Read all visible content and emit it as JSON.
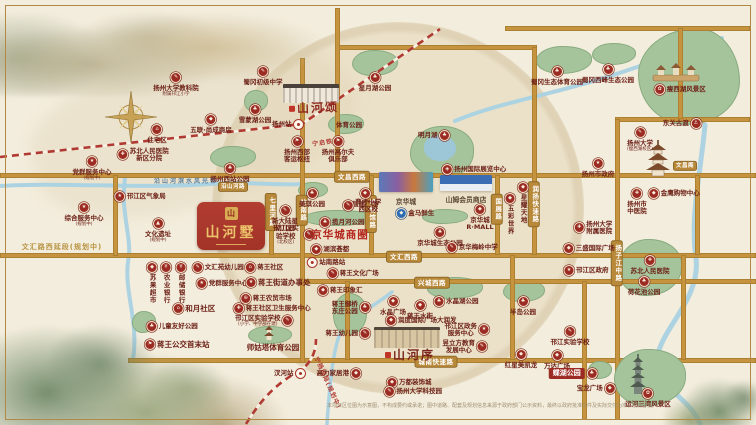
{
  "colors": {
    "paper": "#f3eddd",
    "road_gold": "#c6933e",
    "pill_gold": "#b9893a",
    "badge_red": "#9c2b24",
    "badge_blue": "#2a6bb5",
    "park_green": "#a6c49c",
    "river_blue": "#a9d2e3",
    "rail_red": "#b03a32",
    "project_red": "#b23d31",
    "seal_gold": "#d9ad55",
    "biz_red": "#b5241c",
    "text_dark": "#6e2218"
  },
  "projects": {
    "main": {
      "name": "山河墅",
      "x": 197,
      "y": 202,
      "w": 68,
      "h": 48
    },
    "song": {
      "name": "山河颂",
      "bx": 283,
      "by": 84,
      "bw": 56,
      "bh": 15,
      "tx": 314,
      "ty": 99
    },
    "xu": {
      "name": "山河序",
      "bx": 374,
      "by": 327,
      "bw": 66,
      "bh": 18,
      "tx": 410,
      "ty": 346
    }
  },
  "malls": [
    {
      "name": "京华城",
      "x": 379,
      "y": 172,
      "w": 54,
      "h": 20,
      "ly": 196,
      "style": "jhc"
    },
    {
      "name": "山姆会员商店",
      "x": 440,
      "y": 175,
      "w": 52,
      "h": 16,
      "ly": 194,
      "style": "sam"
    }
  ],
  "roads": {
    "h": [
      {
        "y": 175,
        "x1": 0,
        "x2": 756
      },
      {
        "y": 255,
        "x1": 0,
        "x2": 756
      },
      {
        "y": 281,
        "x1": 302,
        "x2": 756
      },
      {
        "y": 360,
        "x1": 128,
        "x2": 756
      },
      {
        "y": 47,
        "x1": 337,
        "x2": 537
      },
      {
        "y": 28,
        "x1": 505,
        "x2": 750
      },
      {
        "y": 119,
        "x1": 615,
        "x2": 750
      }
    ],
    "v": [
      {
        "x": 302,
        "y1": 58,
        "y2": 363
      },
      {
        "x": 337,
        "y1": 8,
        "y2": 175
      },
      {
        "x": 271,
        "y1": 196,
        "y2": 255
      },
      {
        "x": 371,
        "y1": 175,
        "y2": 255
      },
      {
        "x": 497,
        "y1": 175,
        "y2": 255
      },
      {
        "x": 534,
        "y1": 47,
        "y2": 255
      },
      {
        "x": 617,
        "y1": 119,
        "y2": 420
      },
      {
        "x": 584,
        "y1": 281,
        "y2": 420
      },
      {
        "x": 683,
        "y1": 255,
        "y2": 360
      },
      {
        "x": 697,
        "y1": 175,
        "y2": 255
      },
      {
        "x": 512,
        "y1": 255,
        "y2": 360
      },
      {
        "x": 347,
        "y1": 281,
        "y2": 360
      },
      {
        "x": 115,
        "y1": 175,
        "y2": 256
      },
      {
        "x": 680,
        "y1": 28,
        "y2": 119
      }
    ],
    "pills": [
      {
        "label": "文昌西路",
        "x": 352,
        "y": 177
      },
      {
        "label": "文汇西路",
        "x": 404,
        "y": 257
      },
      {
        "label": "兴城西路",
        "x": 432,
        "y": 283
      },
      {
        "label": "城南快速路",
        "x": 436,
        "y": 362
      },
      {
        "label": "站南路",
        "x": 302,
        "y": 210,
        "vert": true
      },
      {
        "label": "七里河路",
        "x": 271,
        "y": 212,
        "vert": true
      },
      {
        "label": "博物馆路",
        "x": 371,
        "y": 214,
        "vert": true
      },
      {
        "label": "国展路",
        "x": 497,
        "y": 209,
        "vert": true
      },
      {
        "label": "润扬快速路",
        "x": 534,
        "y": 204,
        "vert": true
      },
      {
        "label": "扬子江中路",
        "x": 617,
        "y": 263,
        "vert": true
      },
      {
        "label": "沿山河路",
        "x": 233,
        "y": 187,
        "small": true
      },
      {
        "label": "文昌阁",
        "x": 685,
        "y": 166,
        "small": true
      }
    ],
    "extra": [
      {
        "label": "文汇路西延段(规划中)",
        "x": 62,
        "y": 242
      }
    ]
  },
  "railways": {
    "lines": [
      {
        "d": "M0,157 L302,124 L440,29"
      },
      {
        "d": "M246,424 C262,398 276,384 299,371 C311,364 316,352 316,339"
      }
    ],
    "labels": [
      {
        "label": "宁启铁路",
        "x": 312,
        "y": 137,
        "rot": -8
      },
      {
        "label": "宁扬城际(规划中)",
        "x": 300,
        "y": 378,
        "rot": 66
      }
    ]
  },
  "rivers": [
    {
      "d": "M0,186 C60,182 140,189 210,184 C250,181 280,186 303,184",
      "w": 4
    },
    {
      "d": "M125,178 C120,215 133,238 128,262 C124,292 139,322 133,360",
      "w": 4
    },
    {
      "d": "M455,121 C505,100 565,93 640,66 C678,53 700,48 722,38",
      "w": 4
    },
    {
      "d": "M705,125 C700,178 690,218 696,258 C701,300 659,330 657,360 C655,386 692,400 700,424",
      "w": 5
    },
    {
      "d": "M392,292 C372,308 352,316 342,330 C334,343 330,378 327,424",
      "w": 3.5
    }
  ],
  "parks": [
    {
      "x": 352,
      "y": 50,
      "w": 44,
      "h": 24
    },
    {
      "x": 244,
      "y": 90,
      "w": 22,
      "h": 20
    },
    {
      "x": 210,
      "y": 146,
      "w": 44,
      "h": 20
    },
    {
      "x": 328,
      "y": 114,
      "w": 34,
      "h": 18
    },
    {
      "x": 536,
      "y": 46,
      "w": 54,
      "h": 26
    },
    {
      "x": 592,
      "y": 43,
      "w": 42,
      "h": 20
    },
    {
      "x": 638,
      "y": 28,
      "w": 100,
      "h": 95,
      "r": "58% 42% 52% 48% / 48% 55% 45% 52%"
    },
    {
      "x": 410,
      "y": 126,
      "w": 62,
      "h": 50,
      "r": "50% 50% 46% 54% / 55% 45% 52% 48%"
    },
    {
      "x": 303,
      "y": 210,
      "w": 70,
      "h": 14
    },
    {
      "x": 422,
      "y": 209,
      "w": 44,
      "h": 13
    },
    {
      "x": 503,
      "y": 280,
      "w": 40,
      "h": 20
    },
    {
      "x": 427,
      "y": 277,
      "w": 54,
      "h": 20
    },
    {
      "x": 333,
      "y": 293,
      "w": 32,
      "h": 40
    },
    {
      "x": 132,
      "y": 311,
      "w": 22,
      "h": 20,
      "front": true
    },
    {
      "x": 248,
      "y": 326,
      "w": 42,
      "h": 16,
      "front": true
    },
    {
      "x": 618,
      "y": 239,
      "w": 62,
      "h": 55
    },
    {
      "x": 614,
      "y": 349,
      "w": 70,
      "h": 55,
      "front": true
    },
    {
      "x": 298,
      "y": 182,
      "w": 28,
      "h": 14
    },
    {
      "x": 588,
      "y": 361,
      "w": 22,
      "h": 16,
      "front": true
    }
  ],
  "lakes": [
    {
      "x": 424,
      "y": 135,
      "w": 32,
      "h": 26
    }
  ],
  "water_text": {
    "label": "沿山河滨水风光带",
    "x": 186,
    "y": 176
  },
  "pois": [
    {
      "l": "扬州大学教科院",
      "s": "附属邗江小学",
      "x": 176,
      "y": 72,
      "b": "top",
      "i": "school"
    },
    {
      "l": "蜀冈初级中学",
      "x": 263,
      "y": 66,
      "b": "top",
      "i": "school"
    },
    {
      "l": "星月湖公园",
      "x": 375,
      "y": 72,
      "b": "top",
      "i": "park"
    },
    {
      "l": "雪蒙湖公园",
      "x": 255,
      "y": 104,
      "b": "top",
      "i": "park"
    },
    {
      "l": "五联·尚成商房",
      "x": 211,
      "y": 114,
      "b": "top",
      "i": "shop"
    },
    {
      "l": "住宅区",
      "x": 157,
      "y": 124,
      "b": "top",
      "i": "home"
    },
    {
      "l": "苏北人民医院",
      "s": "新区分院",
      "eq": true,
      "x": 143,
      "y": 147,
      "b": "left",
      "i": "hospital"
    },
    {
      "l": "党群服务中心",
      "s": "(规划中)",
      "x": 92,
      "y": 156,
      "b": "top",
      "i": "star"
    },
    {
      "l": "综合服务中心",
      "s": "(规划中)",
      "x": 84,
      "y": 202,
      "b": "top",
      "i": "gov"
    },
    {
      "l": "邗江区气象局",
      "x": 140,
      "y": 191,
      "b": "left",
      "i": "gov"
    },
    {
      "l": "文化遗址",
      "s": "(规划中)",
      "x": 158,
      "y": 218,
      "b": "top",
      "i": "heritage"
    },
    {
      "l": "扬州西站公园",
      "x": 230,
      "y": 163,
      "b": "top",
      "i": "park"
    },
    {
      "l": "扬州站",
      "x": 288,
      "y": 119,
      "b": "right",
      "i": "rail"
    },
    {
      "l": "体育公园",
      "x": 349,
      "y": 121,
      "b": "none"
    },
    {
      "l": "扬州西部",
      "s": "客运枢纽",
      "eq": true,
      "x": 297,
      "y": 136,
      "b": "top",
      "i": "bus"
    },
    {
      "l": "扬州高尔夫",
      "s": "俱乐部",
      "eq": true,
      "x": 338,
      "y": 136,
      "b": "top",
      "i": "golf"
    },
    {
      "l": "明月湖",
      "x": 434,
      "y": 130,
      "b": "right",
      "i": "park"
    },
    {
      "l": "扬州国际展览中心",
      "x": 474,
      "y": 164,
      "b": "left",
      "i": "expo"
    },
    {
      "l": "蜀冈生态体育公园",
      "x": 557,
      "y": 66,
      "b": "top",
      "i": "park"
    },
    {
      "l": "蜀冈西峰生态公园",
      "x": 608,
      "y": 64,
      "b": "top",
      "i": "park"
    },
    {
      "l": "瘦西湖风景区",
      "x": 680,
      "y": 84,
      "b": "left",
      "i": "scenic"
    },
    {
      "l": "东关古渡",
      "x": 682,
      "y": 118,
      "b": "right",
      "i": "ferry"
    },
    {
      "l": "扬州大学",
      "s": "(瘦西湖校区)",
      "x": 640,
      "y": 127,
      "b": "top",
      "i": "school"
    },
    {
      "l": "扬州市政府",
      "x": 598,
      "y": 158,
      "b": "top",
      "i": "star"
    },
    {
      "l": "美琪公园",
      "x": 312,
      "y": 188,
      "b": "top",
      "i": "park"
    },
    {
      "l": "昌建广场",
      "x": 365,
      "y": 188,
      "b": "top",
      "i": "shop"
    },
    {
      "l": "育才小学",
      "s": "西区校",
      "eq": true,
      "x": 362,
      "y": 198,
      "b": "left",
      "i": "school"
    },
    {
      "l": "新大陆星",
      "s": "幼儿园",
      "eq": true,
      "x": 285,
      "y": 205,
      "b": "top",
      "i": "school"
    },
    {
      "l": "邗江区实验学校",
      "s": "(北校区)",
      "x": 292,
      "y": 224,
      "b": "right",
      "i": "school",
      "w": 32
    },
    {
      "l": "揽月河公园",
      "x": 342,
      "y": 217,
      "b": "left",
      "i": "park"
    },
    {
      "l": "京华城商圈",
      "x": 340,
      "y": 229,
      "c": "biz",
      "b": "none"
    },
    {
      "l": "湖滨荟都",
      "x": 330,
      "y": 244,
      "b": "left",
      "i": "shop"
    },
    {
      "l": "站南路站",
      "x": 326,
      "y": 257,
      "b": "left",
      "i": "metro"
    },
    {
      "l": "蒋王文化广场",
      "x": 353,
      "y": 268,
      "b": "left",
      "i": "culture"
    },
    {
      "l": "蒋王印象汇",
      "x": 340,
      "y": 285,
      "b": "left",
      "i": "shop"
    },
    {
      "l": "盒马鲜生",
      "x": 415,
      "y": 208,
      "b": "left",
      "i": "hema"
    },
    {
      "l": "京华城生态公园",
      "x": 440,
      "y": 227,
      "b": "top",
      "i": "park"
    },
    {
      "l": "京华城",
      "s": "R·MALL",
      "eq": true,
      "x": 480,
      "y": 204,
      "b": "top",
      "i": "shop"
    },
    {
      "l": "京华梅岭中学",
      "x": 472,
      "y": 242,
      "b": "left",
      "i": "school"
    },
    {
      "l": "星耀天地",
      "x": 523,
      "y": 182,
      "b": "top",
      "i": "shop",
      "v": true
    },
    {
      "l": "五彩世界",
      "x": 510,
      "y": 193,
      "b": "top",
      "i": "shop",
      "v": true
    },
    {
      "l": "扬州市",
      "s": "中医院",
      "eq": true,
      "x": 637,
      "y": 188,
      "b": "top",
      "i": "hospital"
    },
    {
      "l": "金鹰购物中心",
      "x": 674,
      "y": 188,
      "b": "left",
      "i": "shop"
    },
    {
      "l": "扬州大学",
      "s": "附属医院",
      "eq": true,
      "x": 593,
      "y": 220,
      "b": "left",
      "i": "hospital"
    },
    {
      "l": "三盛国际广场",
      "x": 589,
      "y": 243,
      "b": "left",
      "i": "shop"
    },
    {
      "l": "邗江区政府",
      "x": 586,
      "y": 265,
      "b": "left",
      "i": "star"
    },
    {
      "l": "苏北人民医院",
      "x": 650,
      "y": 255,
      "b": "top",
      "i": "hospital"
    },
    {
      "l": "荷花池公园",
      "x": 644,
      "y": 276,
      "b": "top",
      "i": "park"
    },
    {
      "l": "苏果超市",
      "x": 152,
      "y": 262,
      "b": "top",
      "i": "shop",
      "v": true
    },
    {
      "l": "农业银行",
      "x": 166,
      "y": 262,
      "b": "top",
      "i": "bank",
      "v": true
    },
    {
      "l": "邮储银行",
      "x": 181,
      "y": 262,
      "b": "top",
      "i": "bank",
      "v": true
    },
    {
      "l": "文汇苑幼儿园",
      "x": 218,
      "y": 262,
      "b": "left",
      "i": "school"
    },
    {
      "l": "蒋王社区",
      "x": 264,
      "y": 262,
      "b": "left",
      "i": "community"
    },
    {
      "l": "党群服务中心",
      "x": 222,
      "y": 278,
      "b": "left",
      "i": "star"
    },
    {
      "l": "蒋王街道办事处",
      "x": 278,
      "y": 277,
      "b": "left",
      "i": "gov",
      "c": "lg"
    },
    {
      "l": "蒋王农贸市场",
      "x": 266,
      "y": 293,
      "b": "left",
      "i": "market"
    },
    {
      "l": "蒋王社区卫生服务中心",
      "x": 272,
      "y": 303,
      "b": "left",
      "i": "hospital"
    },
    {
      "l": "和月社区",
      "x": 194,
      "y": 303,
      "b": "left",
      "i": "community",
      "c": "lg"
    },
    {
      "l": "邗江区实验学校",
      "s": "(小学、中学部在建)",
      "x": 264,
      "y": 314,
      "b": "right",
      "i": "school"
    },
    {
      "l": "儿童友好公园",
      "x": 172,
      "y": 321,
      "b": "left",
      "i": "park"
    },
    {
      "l": "蒋王公交首末站",
      "x": 177,
      "y": 339,
      "b": "left",
      "i": "bus",
      "c": "lg"
    },
    {
      "l": "师姑塔体育公园",
      "x": 273,
      "y": 343,
      "b": "none",
      "c": "lg"
    },
    {
      "l": "蒋王御桥",
      "s": "东庄公园",
      "eq": true,
      "x": 351,
      "y": 300,
      "b": "right",
      "i": "park"
    },
    {
      "l": "蒋王幼儿园",
      "x": 348,
      "y": 328,
      "b": "right",
      "i": "school"
    },
    {
      "l": "水晶广场",
      "x": 393,
      "y": 296,
      "b": "top",
      "i": "shop"
    },
    {
      "l": "蒋王水街",
      "x": 420,
      "y": 300,
      "b": "top",
      "i": "shop"
    },
    {
      "l": "水晶湖公园",
      "x": 456,
      "y": 296,
      "b": "left",
      "i": "park"
    },
    {
      "l": "润度国际广场大润发",
      "x": 421,
      "y": 315,
      "b": "left",
      "i": "shop"
    },
    {
      "l": "邗江区政务",
      "s": "服务中心",
      "eq": true,
      "x": 467,
      "y": 322,
      "b": "right",
      "i": "gov"
    },
    {
      "l": "昱立方教育",
      "s": "发展中心",
      "eq": true,
      "x": 465,
      "y": 339,
      "b": "right",
      "i": "edu"
    },
    {
      "l": "半岛公园",
      "x": 523,
      "y": 296,
      "b": "top",
      "i": "park"
    },
    {
      "l": "红星美凯龙",
      "x": 521,
      "y": 349,
      "b": "top",
      "i": "shop"
    },
    {
      "l": "万达广场",
      "x": 557,
      "y": 350,
      "b": "top",
      "i": "shop"
    },
    {
      "l": "邗江实验学校",
      "x": 570,
      "y": 326,
      "b": "top",
      "i": "school"
    },
    {
      "l": "蝶湖公园",
      "x": 573,
      "y": 368,
      "b": "right",
      "i": "park",
      "c": "pillred"
    },
    {
      "l": "宝龙广场",
      "x": 596,
      "y": 383,
      "b": "right",
      "i": "shop"
    },
    {
      "l": "运河三湾风景区",
      "x": 648,
      "y": 388,
      "b": "top",
      "i": "scenic"
    },
    {
      "l": "高力家居港",
      "x": 339,
      "y": 368,
      "b": "right",
      "i": "shop"
    },
    {
      "l": "万都装饰城",
      "x": 409,
      "y": 377,
      "b": "left",
      "i": "shop"
    },
    {
      "l": "扬州大学科技园",
      "x": 413,
      "y": 386,
      "b": "left",
      "i": "school"
    },
    {
      "l": "汊河站",
      "x": 290,
      "y": 368,
      "b": "right",
      "i": "rail"
    }
  ],
  "icons": {
    "school": "✎",
    "hospital": "✚",
    "park": "♣",
    "shop": "◆",
    "bank": "¥",
    "star": "★",
    "gov": "★",
    "bus": "⚑",
    "golf": "⚑",
    "ferry": "⚓",
    "scenic": "✿",
    "culture": "✎",
    "market": "⊕",
    "community": "⌂",
    "home": "⌂",
    "edu": "✎",
    "expo": "◈",
    "heritage": "▲",
    "hema": "◆"
  },
  "disclaimer": {
    "text": "本项目区位图为示意图，不构成要约或承诺；图中道路、配套及规划信息来源于政府部门公示资料，最终以政府批准文件及实际交付为准，敬请留意。"
  }
}
